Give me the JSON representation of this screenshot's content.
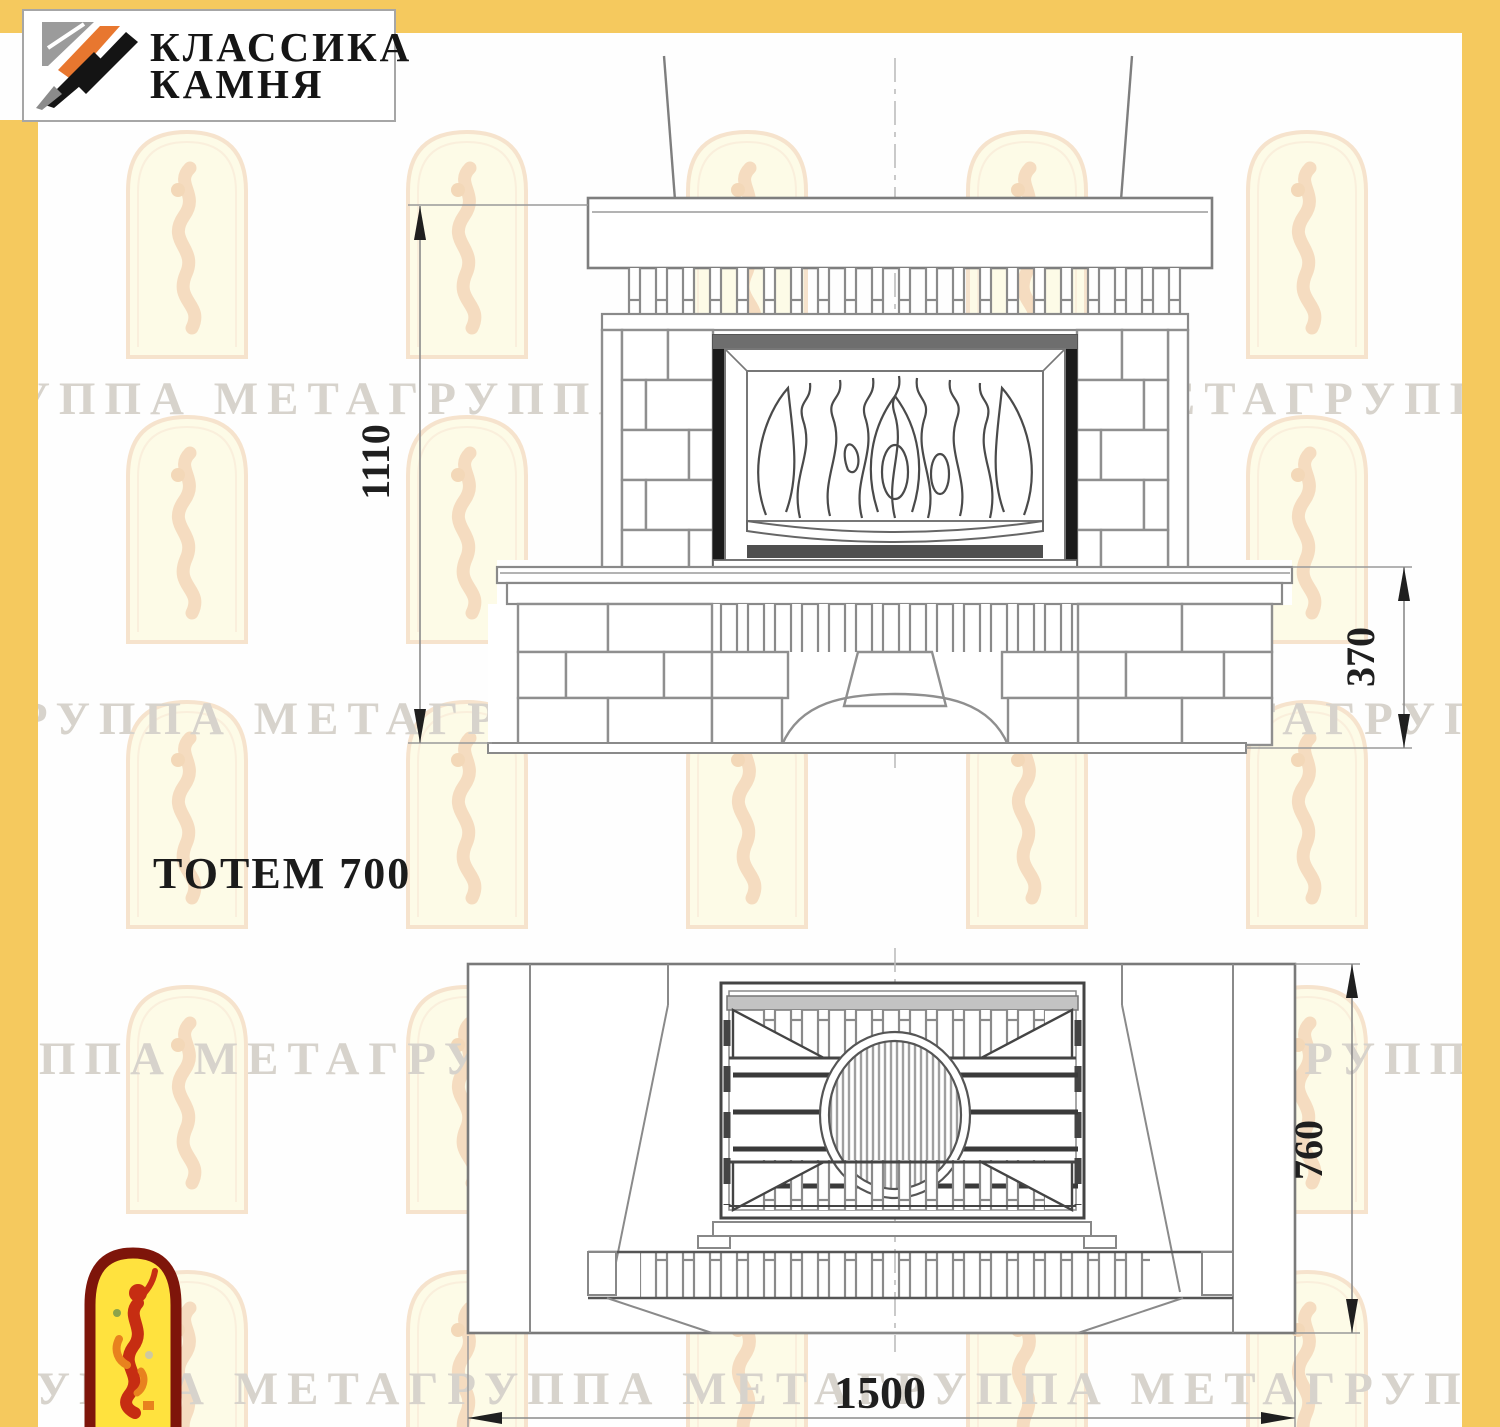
{
  "brand": {
    "name_line1": "КЛАССИКА",
    "name_line2": "КАМНЯ",
    "icon": "diagonal-stripes-logo"
  },
  "title": "ТОТЕМ 700",
  "views": {
    "front": {
      "name": "front-elevation",
      "height_mm": "1110",
      "bench_height_mm": "370"
    },
    "plan": {
      "name": "top-plan",
      "depth_mm": "760",
      "width_mm": "1500"
    }
  },
  "watermark": {
    "text": "ГРУППА МЕТАГРУППА МЕТАГРУППА МЕТАГРУППА МЕТА",
    "arch_icon": "arched-stained-glass-figure"
  },
  "mascot": {
    "icon": "jester-in-arch-emblem"
  },
  "colors": {
    "border_yellow": "#F5C95E",
    "logo_orange": "#E8772F",
    "logo_black": "#141414",
    "logo_gray": "#9B9B9B",
    "drawing_gray": "#8A8A8A",
    "drawing_dark": "#444444",
    "firebox_black": "#1B1B1B",
    "dimension_text": "#1F1F1F",
    "watermark_text_gray": "#D7D3CC",
    "watermark_arch_outline": "#F6E3CD",
    "watermark_arch_fill": "#FDFBE7",
    "mascot_red": "#C62D12",
    "mascot_yellow": "#FFE23E",
    "mascot_border": "#7E150A"
  }
}
